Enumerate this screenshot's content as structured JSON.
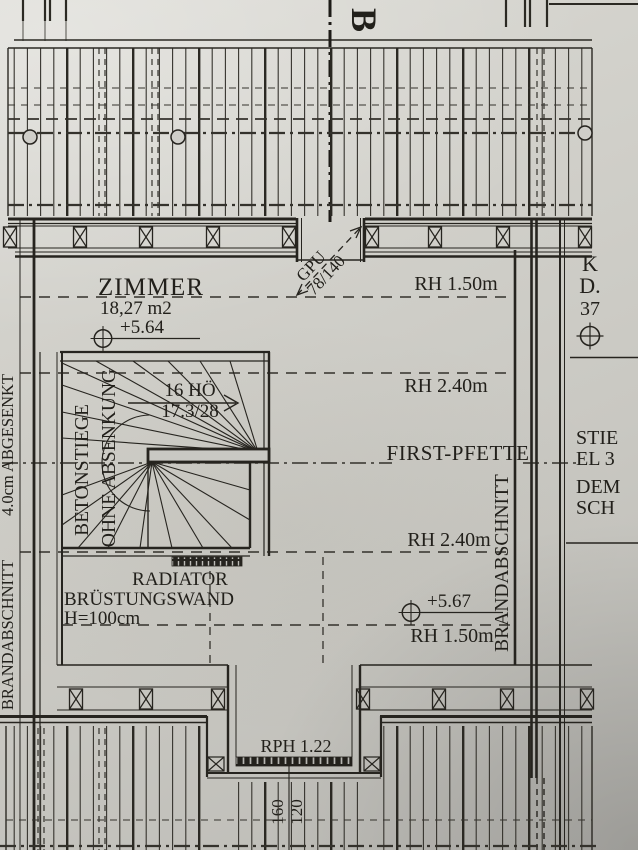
{
  "colors": {
    "paper": "#cfcec9",
    "ink": "#26241f"
  },
  "plan": {
    "section_marker": "B",
    "roof_window": {
      "line1": "GPU",
      "line2": "78/140"
    },
    "room": {
      "name": "ZIMMER",
      "area": "18,27 m2",
      "level_upper": "+5.64",
      "level_lower": "+5.67"
    },
    "heights": {
      "top": "RH 1.50m",
      "upper_mid": "RH 2.40m",
      "ridge": "FIRST-PFETTE",
      "lower_mid": "RH 2.40m",
      "bottom": "RH 1.50m"
    },
    "stair": {
      "steps": "16 HÖ",
      "riser_tread": "17.3/28",
      "type_line1": "BETONSTIEGE",
      "type_line2": "OHNE ABSENKUNG"
    },
    "left_margin": {
      "lowered_note": "4.0cm ABGESENKT",
      "fire_wall": "BRANDABSCHNITT"
    },
    "right_wall_label": "BRANDABSCHNITT",
    "right_margin": {
      "k": "K",
      "d": "D.",
      "num": "37",
      "note1": "STIE",
      "note2": "EL 3",
      "note3": "DEM",
      "note4": "SCH"
    },
    "parapet": {
      "line1": "RADIATOR",
      "line2": "BRÜSTUNGSWAND",
      "line3": "H=100cm"
    },
    "dormer": {
      "rph": "RPH 1.22",
      "dim_top": "160",
      "dim_bottom": "120"
    }
  }
}
